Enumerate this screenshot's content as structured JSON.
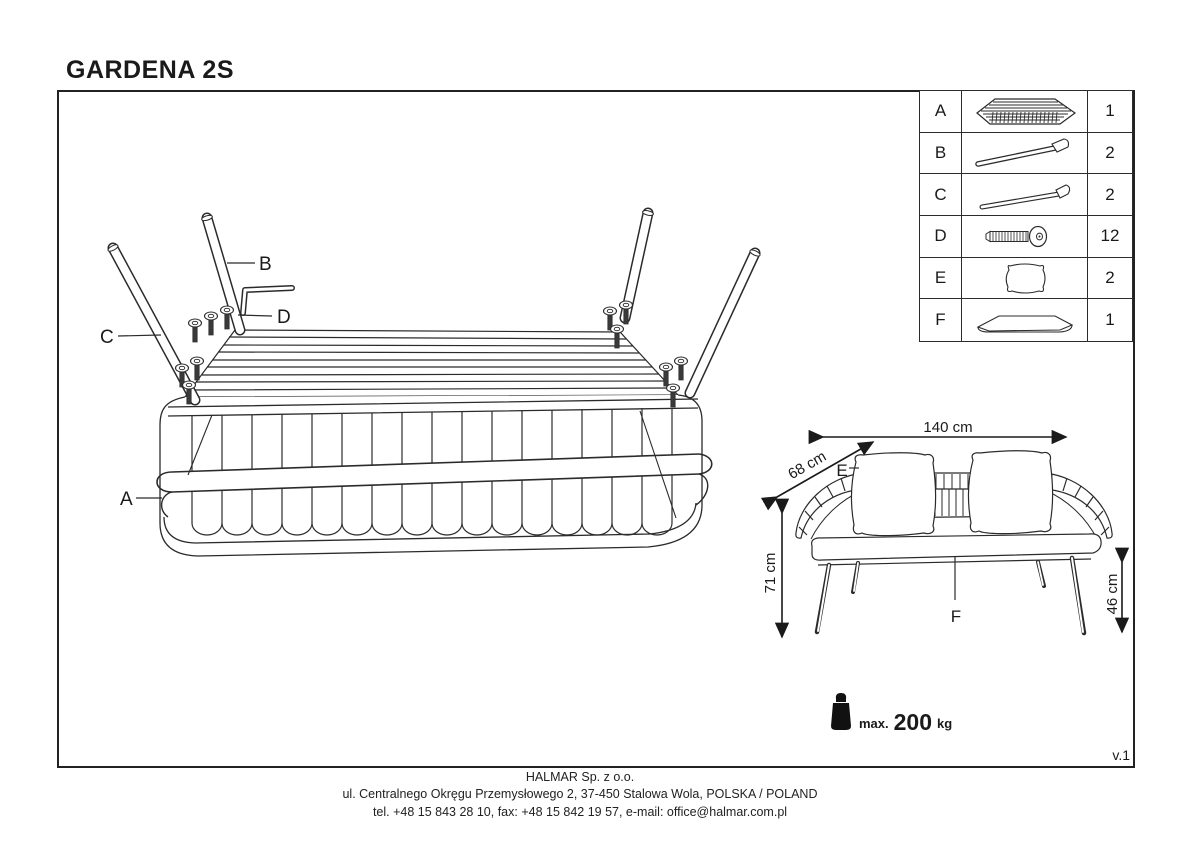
{
  "page": {
    "title": "GARDENA 2S",
    "version": "v.1"
  },
  "colors": {
    "line": "#2b2b2b",
    "background": "#ffffff"
  },
  "parts_table": {
    "rows": [
      {
        "letter": "A",
        "icon": "woven-seat-frame-icon",
        "qty": "1"
      },
      {
        "letter": "B",
        "icon": "rear-leg-icon",
        "qty": "2"
      },
      {
        "letter": "C",
        "icon": "front-leg-icon",
        "qty": "2"
      },
      {
        "letter": "D",
        "icon": "allen-bolt-icon",
        "qty": "12"
      },
      {
        "letter": "E",
        "icon": "pillow-icon",
        "qty": "2"
      },
      {
        "letter": "F",
        "icon": "seat-cushion-icon",
        "qty": "1"
      }
    ]
  },
  "assembly_diagram": {
    "frame_label": "A",
    "rear_leg_label": "B",
    "front_leg_label": "C",
    "bolt_label": "D"
  },
  "dimension_diagram": {
    "width_label": "140 cm",
    "depth_label": "68 cm",
    "height_label": "71 cm",
    "seat_height_label": "46 cm",
    "pillow_label": "E",
    "cushion_label": "F"
  },
  "max_load": {
    "prefix": "max.",
    "value": "200",
    "unit": "kg"
  },
  "footer": {
    "company": "HALMAR Sp. z o.o.",
    "address": "ul. Centralnego Okręgu Przemysłowego 2, 37-450 Stalowa Wola, POLSKA / POLAND",
    "contact": "tel. +48 15 843 28 10, fax: +48 15 842 19 57, e-mail: office@halmar.com.pl"
  }
}
